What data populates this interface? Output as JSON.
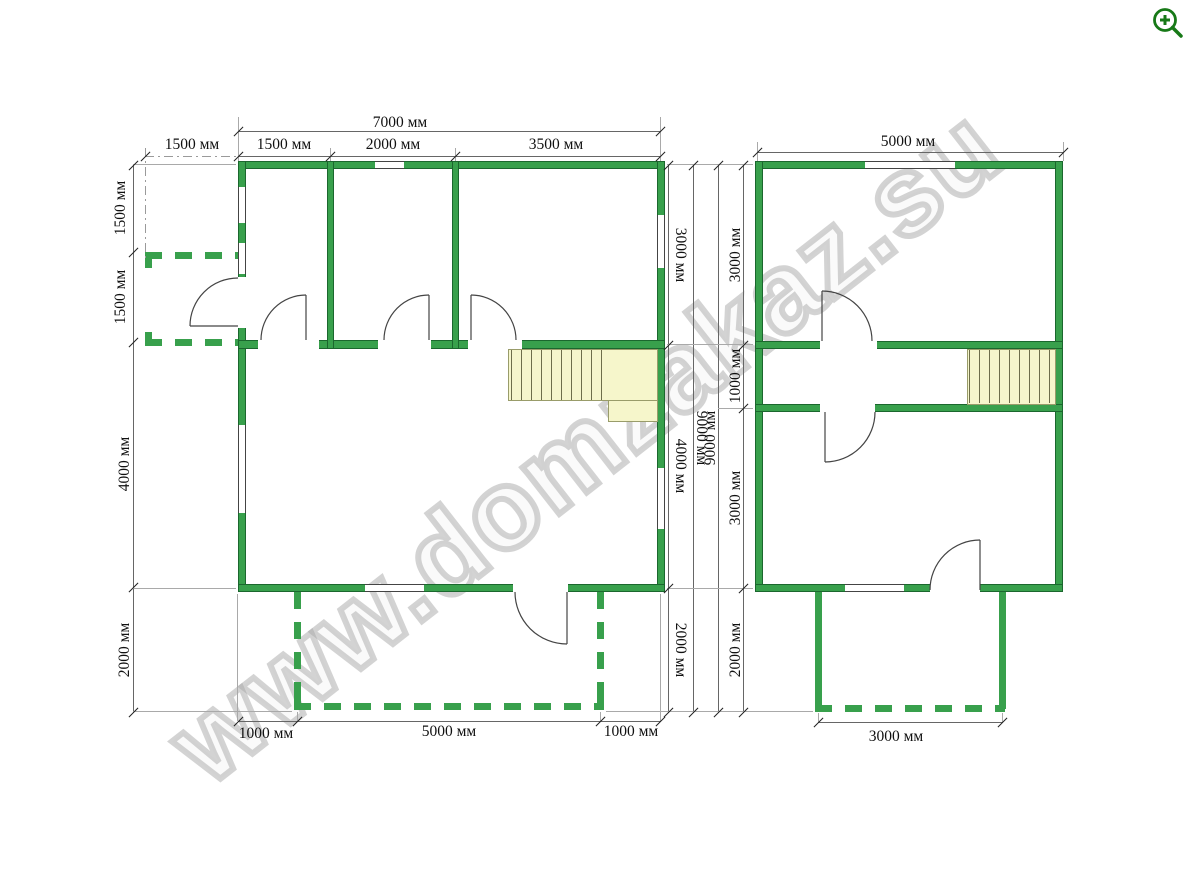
{
  "watermark": {
    "text": "www.domzakaz.su"
  },
  "toolbar": {
    "zoom_icon": "zoom-in"
  },
  "colors": {
    "wall_green": "#38a04c",
    "stairs_fill": "#f6f6cb",
    "watermark_gray": "#a8a8a8",
    "icon_green": "#177917"
  },
  "floor1": {
    "top_total": "7000 мм",
    "top_sub": [
      "1500 мм",
      "1500 мм",
      "2000 мм",
      "3500 мм"
    ],
    "left_sub": [
      "1500 мм",
      "1500 мм",
      "4000 мм",
      "2000 мм"
    ],
    "right_sub": [
      "3000 мм",
      "4000 мм",
      "2000 мм"
    ],
    "right_total": "9000 мм",
    "bottom_sub": [
      "1000 мм",
      "5000 мм",
      "1000 мм"
    ]
  },
  "floor2": {
    "top_total": "5000 мм",
    "left_total": "9000 мм",
    "left_sub": [
      "3000 мм",
      "1000 мм",
      "3000 мм",
      "2000 мм"
    ],
    "bottom_sub": [
      "3000 мм"
    ]
  }
}
